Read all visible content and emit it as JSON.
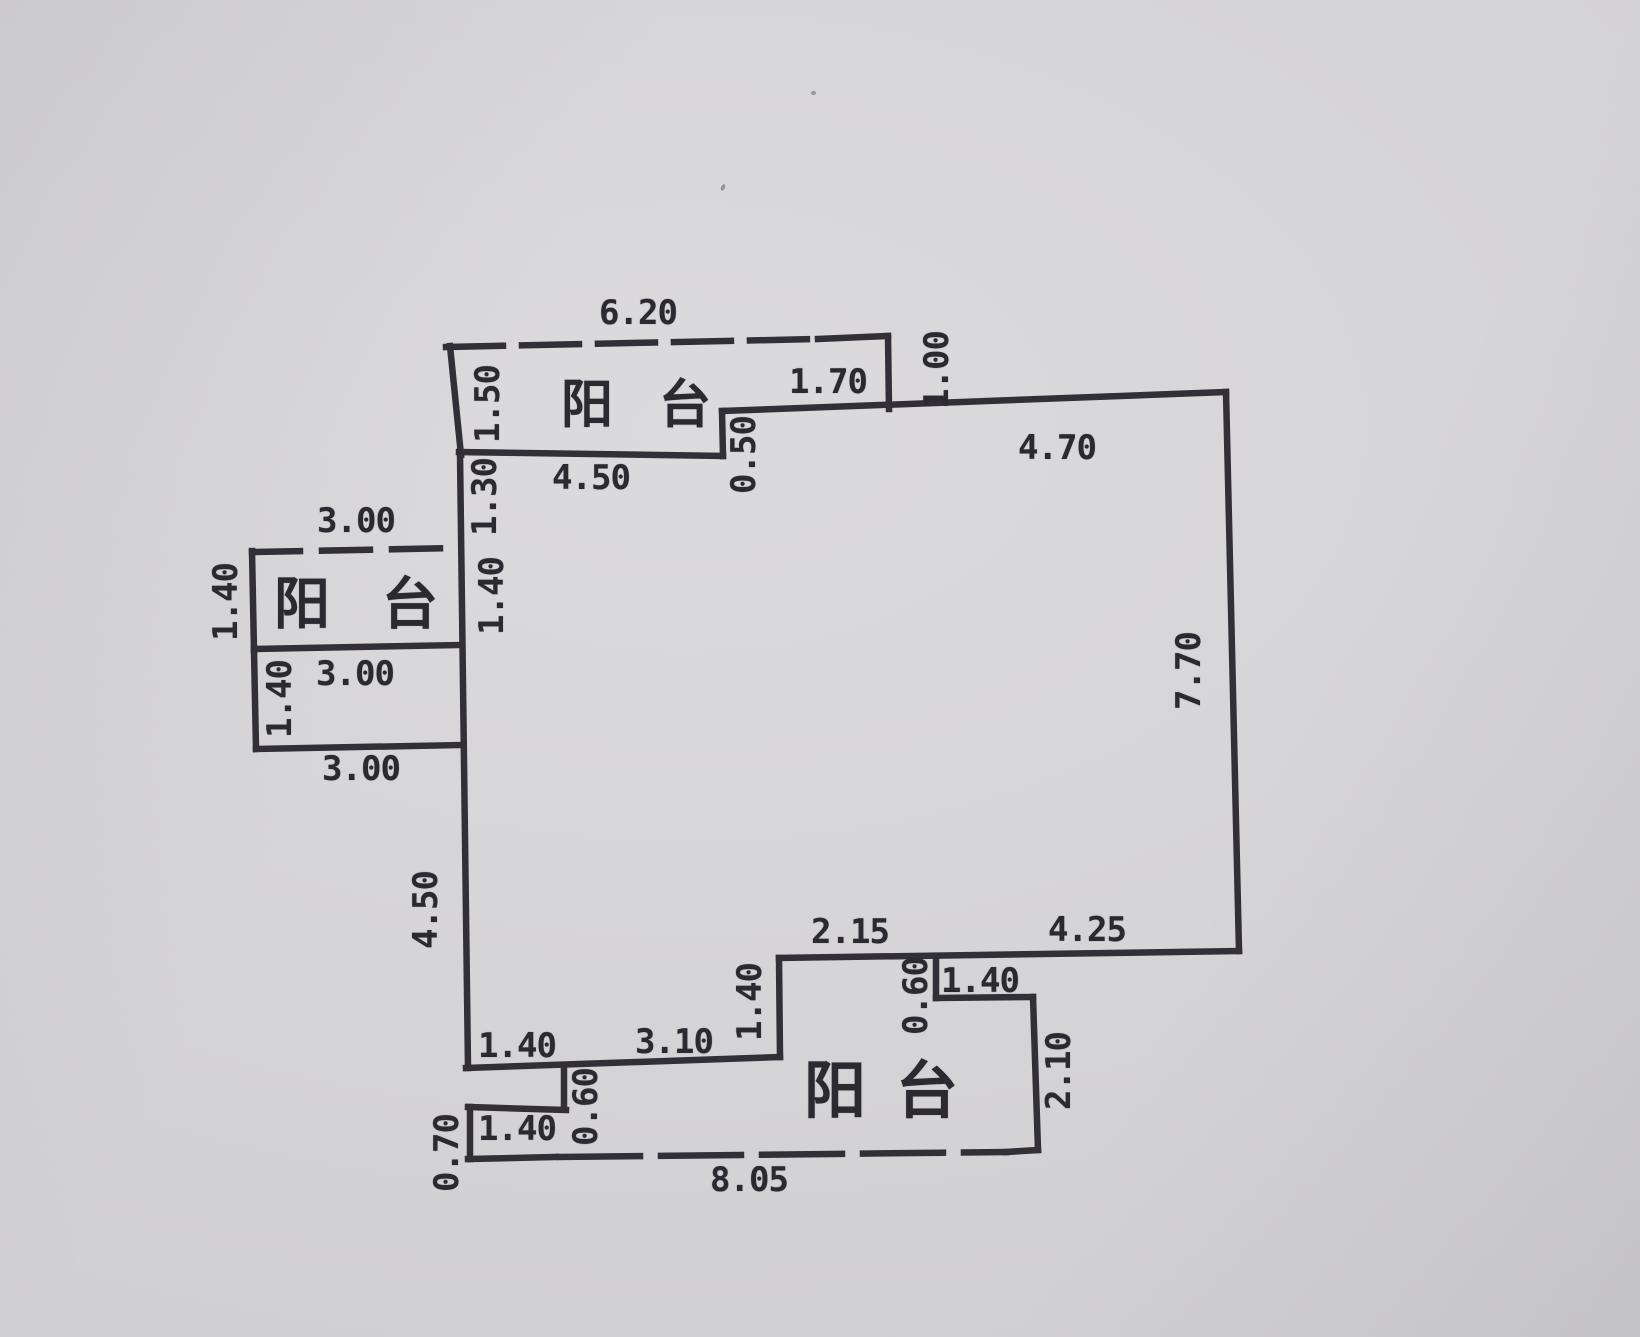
{
  "rooms": {
    "top": "阳台",
    "left": "阳台",
    "bottom": "阳台"
  },
  "dims": {
    "top_balcony_width": "6.20",
    "top_balcony_left": "1.50",
    "top_balcony_right": "1.00",
    "top_balcony_inner": "1.70",
    "top_wall_left": "4.50",
    "top_step": "0.50",
    "top_wall_right": "4.70",
    "left_wall_upper": "1.30",
    "left_wall_mid": "1.40",
    "left_balcony_top": "3.00",
    "left_balcony_left": "1.40",
    "left_balcony_bottom": "3.00",
    "annex_left": "1.40",
    "annex_bottom": "3.00",
    "right_wall": "7.70",
    "left_wall_lower": "4.50",
    "bottom_wall_seg1": "1.40",
    "bottom_wall_seg2": "3.10",
    "bottom_step": "1.40",
    "bottom_right_seg1": "2.15",
    "bottom_right_seg2": "4.25",
    "bottom_balcony_step_height": "0.60",
    "bottom_balcony_step_width": "1.40",
    "bottom_balcony_right": "2.10",
    "porch_step": "0.60",
    "porch_width": "1.40",
    "porch_left": "0.70",
    "bottom_total": "8.05"
  },
  "colors": {
    "paper": "#d4d3d6",
    "ink": "#322f36"
  }
}
